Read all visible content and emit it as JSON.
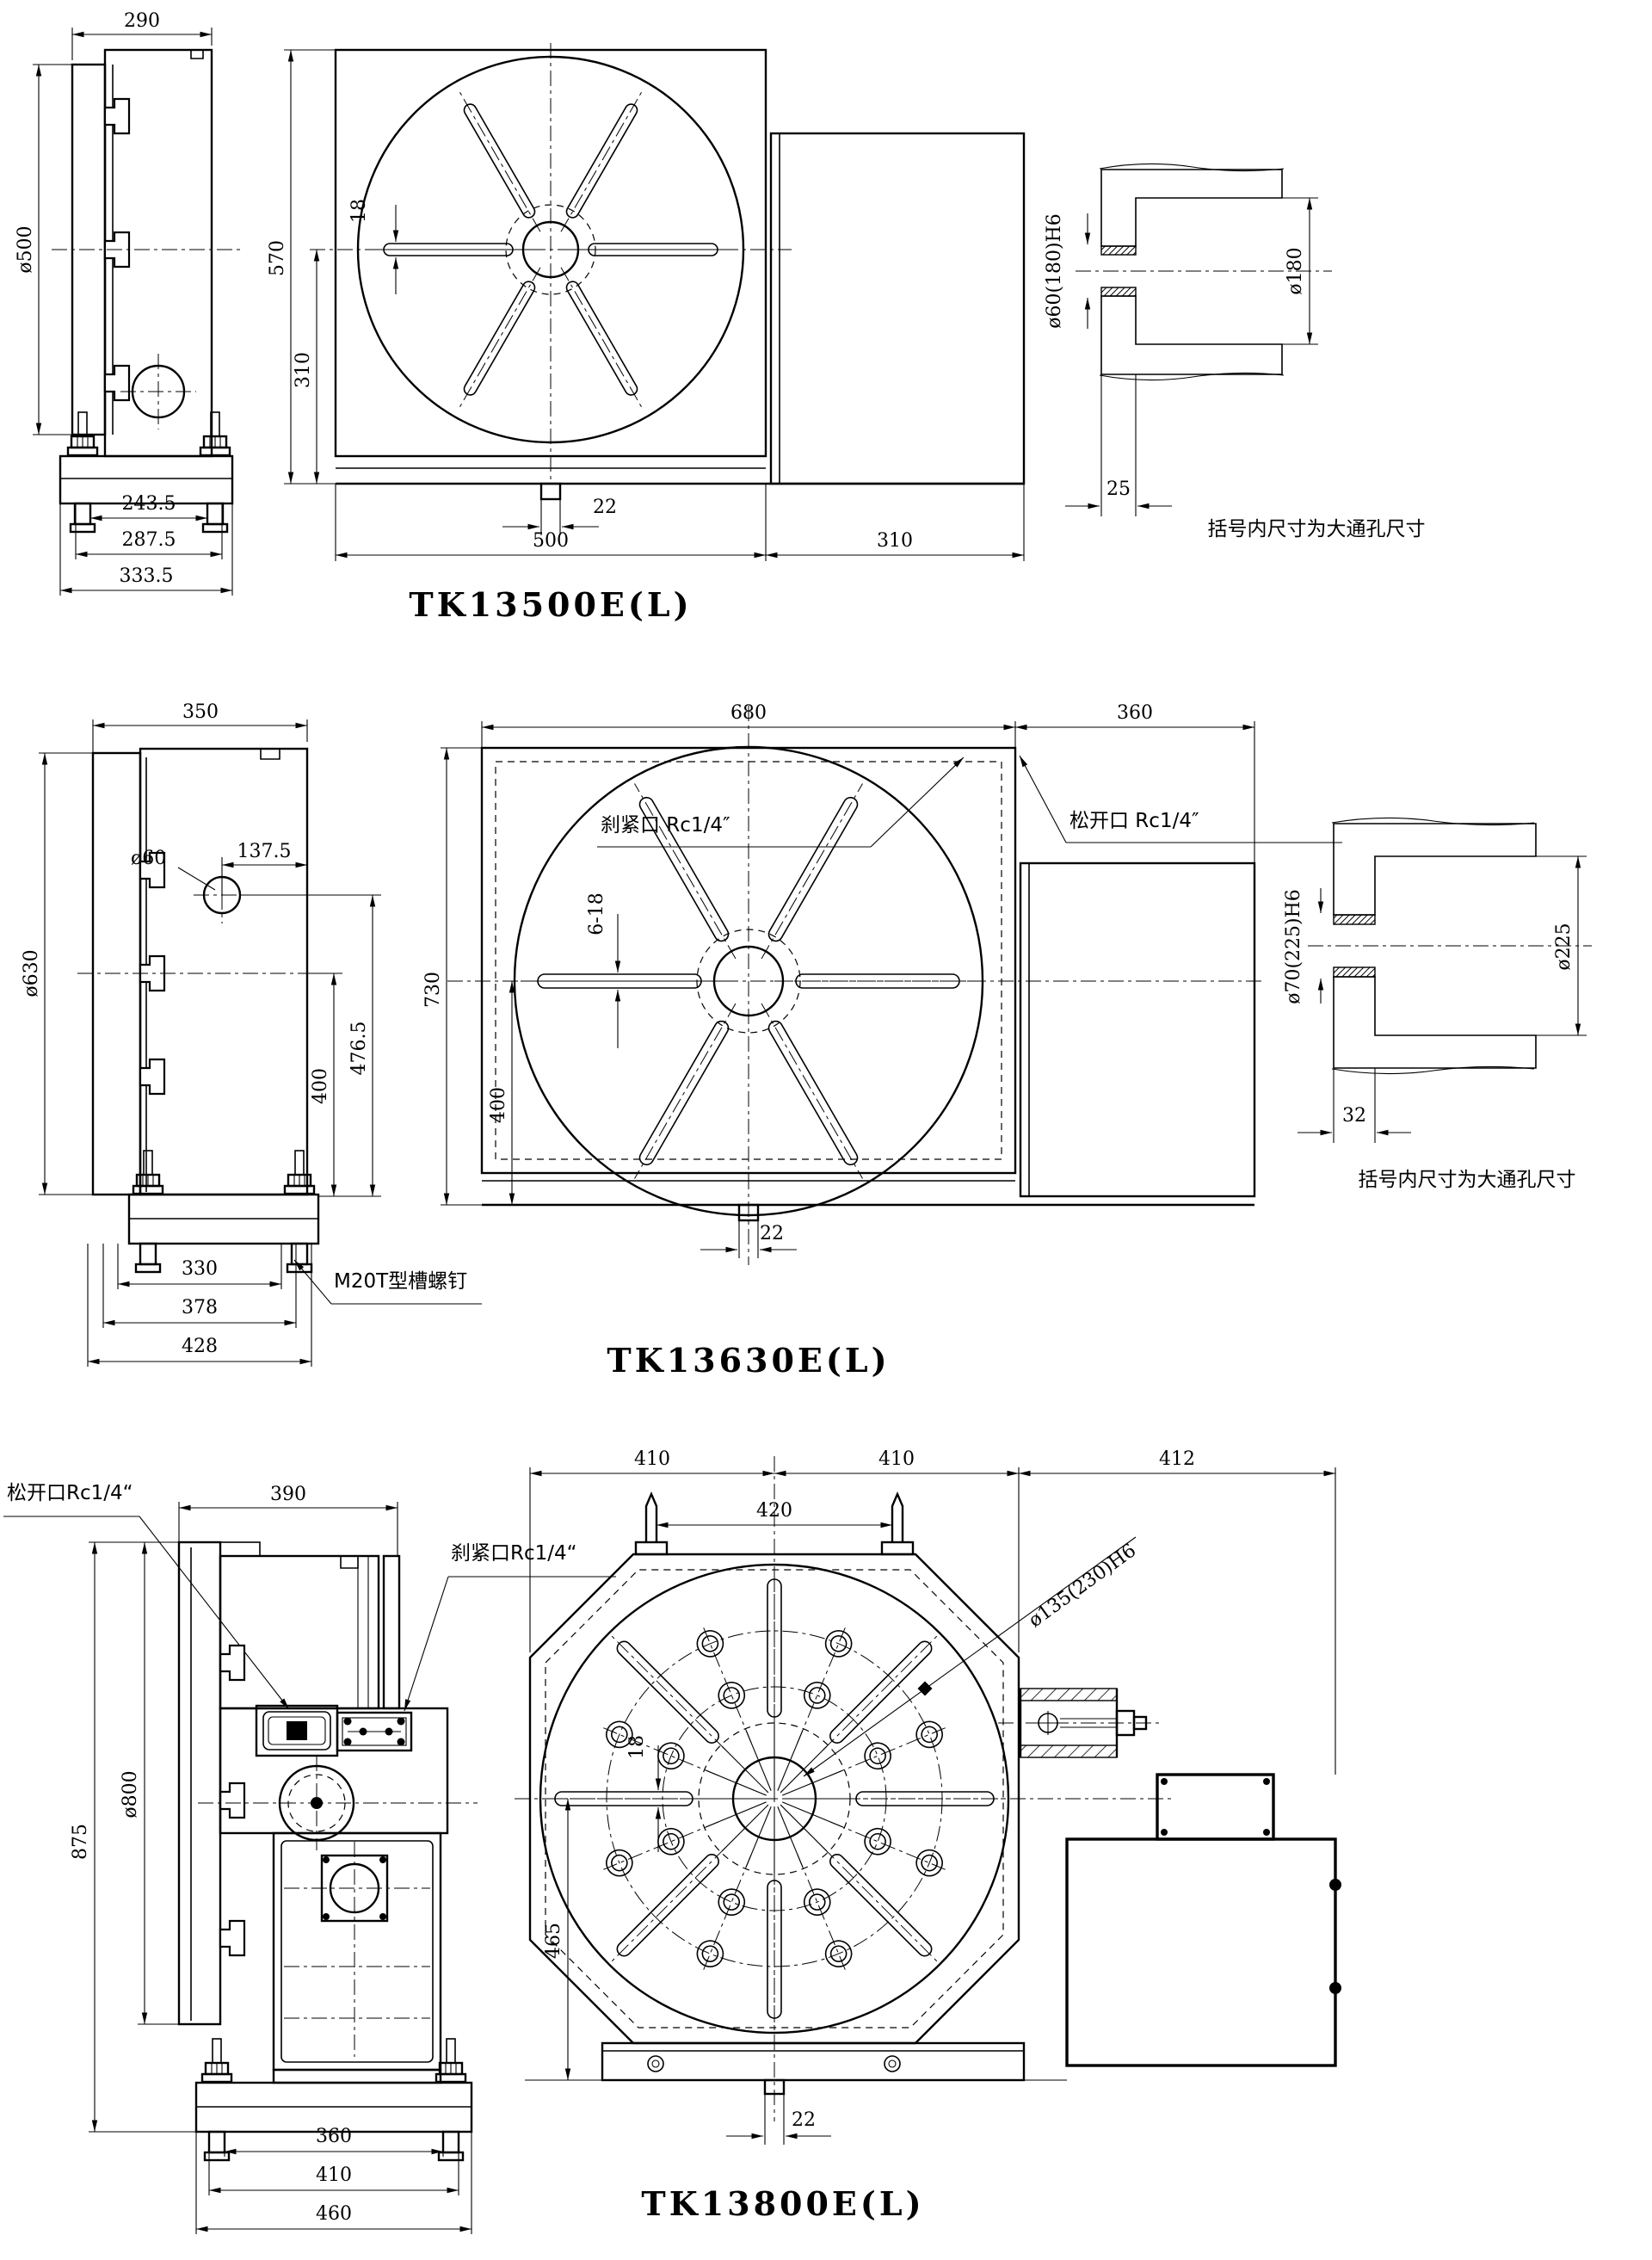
{
  "drawings": {
    "tk13500": {
      "title": "TK13500E(L)",
      "side": {
        "top_width": "290",
        "table_dia": "ø500",
        "bolt_span": "243.5",
        "base_mid": "287.5",
        "base_width": "333.5"
      },
      "front": {
        "height": "570",
        "center_to_base": "310",
        "slot_width": "18",
        "key_width": "22",
        "body_width": "500",
        "motor_width": "310"
      },
      "detail": {
        "bore": "ø60(180)H6",
        "big_bore": "ø180",
        "depth": "25",
        "note": "括号内尺寸为大通孔尺寸"
      }
    },
    "tk13630": {
      "title": "TK13630E(L)",
      "side": {
        "top_width": "350",
        "table_dia": "ø630",
        "hole_offset": "137.5",
        "hole_dia": "ø60",
        "center_to_base": "400",
        "hole_to_base": "476.5",
        "bolt_span": "330",
        "base_mid": "378",
        "base_width": "428",
        "tslot_screw": "M20T型槽螺钉"
      },
      "front": {
        "body_width": "680",
        "motor_width": "360",
        "height": "730",
        "center_to_base": "400",
        "slots": "6-18",
        "key_width": "22",
        "clamp_port": "刹紧口 Rc1/4″",
        "release_port": "松开口 Rc1/4″"
      },
      "detail": {
        "bore": "ø70(225)H6",
        "big_bore": "ø225",
        "depth": "32",
        "note": "括号内尺寸为大通孔尺寸"
      }
    },
    "tk13800": {
      "title": "TK13800E(L)",
      "side": {
        "release_port": "松开口Rc1/4“",
        "clamp_port": "刹紧口Rc1/4“",
        "top_width": "390",
        "height": "875",
        "table_dia": "ø800",
        "bolt_span": "360",
        "base_mid": "410",
        "base_width": "460"
      },
      "front": {
        "left_half": "410",
        "right_half": "410",
        "motor_extent": "412",
        "eyebolt_span": "420",
        "center_bore": "ø135(230)H6",
        "slot_width": "18",
        "center_to_base": "465",
        "key_width": "22"
      }
    }
  }
}
